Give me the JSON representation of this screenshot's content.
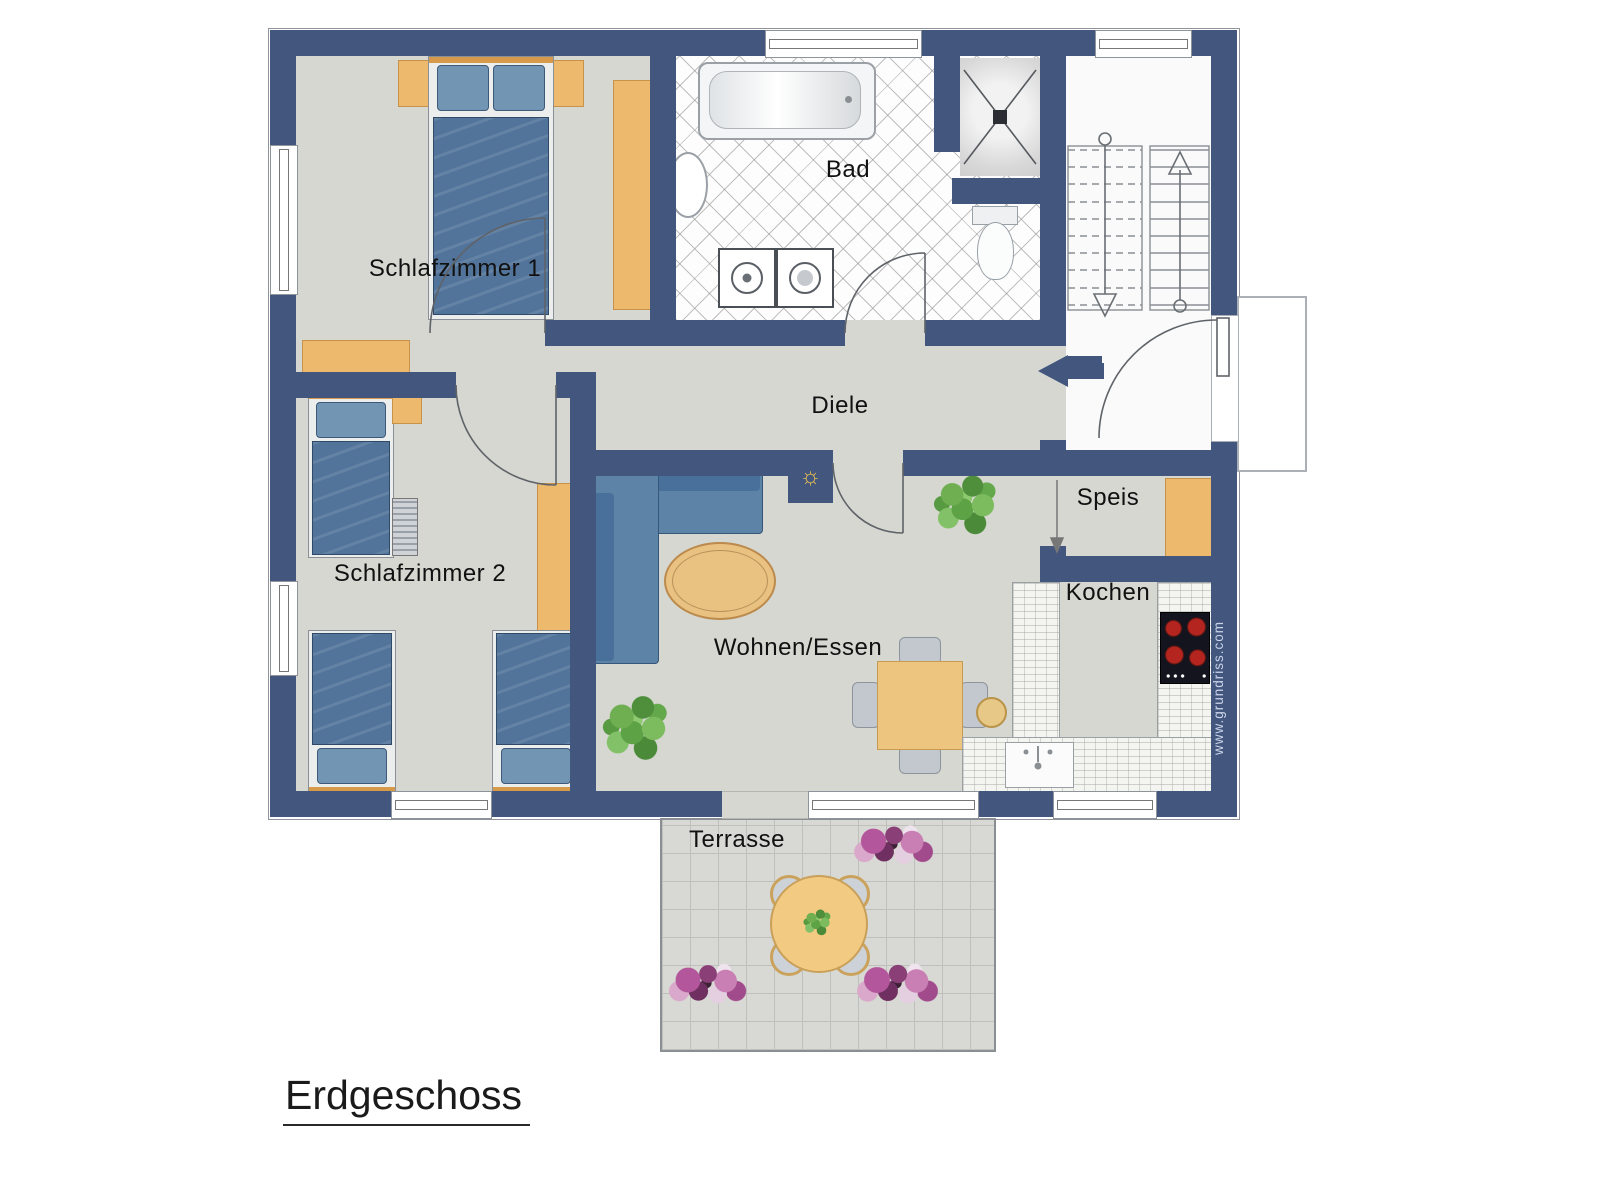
{
  "title": {
    "label": "Erdgeschoss"
  },
  "watermark": "www.grundriss.com",
  "rooms": {
    "schlafzimmer1": "Schlafzimmer 1",
    "schlafzimmer2": "Schlafzimmer 2",
    "bad": "Bad",
    "diele": "Diele",
    "wohnen_essen": "Wohnen/Essen",
    "speis": "Speis",
    "kochen": "Kochen",
    "terrasse": "Terrasse"
  },
  "icons": {
    "ceiling_light_glyph": "☼"
  },
  "colors": {
    "wall": "#42567e",
    "floor": "#d6d7d1",
    "wood": "#ecb96d",
    "bedding_blue": "#52749a",
    "sofa_blue": "#5d83a6",
    "stove_burner_red": "#b3251e",
    "plant_green": "#6faf52",
    "flower_pink": "#b4569b",
    "watermark_text": "#ccd4e9"
  }
}
